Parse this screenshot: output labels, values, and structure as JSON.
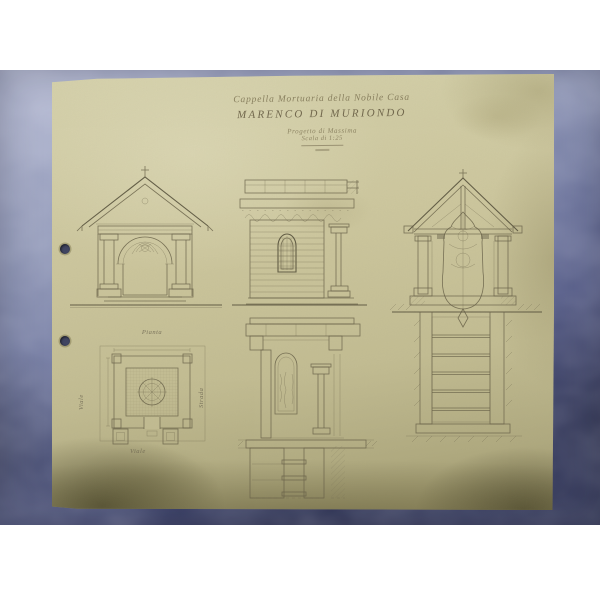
{
  "photo": {
    "background_top_color": "#9aa0bf",
    "background_bottom_color": "#262b50",
    "paper_color": "#ccc69d",
    "paper_edge_color": "#8a8460",
    "ink_color": "#665f47",
    "hole_color": "#3c4160"
  },
  "title_block": {
    "line1": "Cappella Mortuaria della Nobile Casa",
    "line2": "MARENCO DI MURIONDO",
    "line3": "Progetto di Massima",
    "line4": "Scala di 1:25"
  },
  "plan_labels": {
    "top": "Pianta",
    "left": "Viale",
    "right": "Strada",
    "bottom": "Viale"
  }
}
